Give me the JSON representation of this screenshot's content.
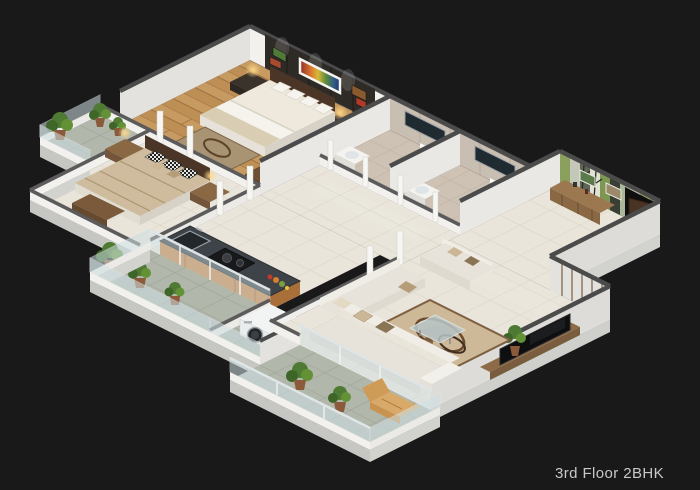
{
  "caption": "3rd Floor 2BHK",
  "colors": {
    "background": "#191919",
    "caption_text": "#c9c9c9",
    "wall_lit": "#f2f1ee",
    "wall_shade": "#dddcd8",
    "wall_cap": "#4b4b4b",
    "wood_floor": "#bd8f55",
    "cream_tile": "#e9e5da",
    "balcony_tile": "#b2b7ac",
    "bath_tile": "#cdc2b4",
    "accent_wall": "#2e2a26",
    "green_feature_wall": "#8ca05e",
    "kitchen_cabinet": "#c98546",
    "counter_top": "#3d4348",
    "sofa_cream": "#e7e3da",
    "glass": "#cfe0e4",
    "plant_green": "#4e7a33",
    "door_wood": "#4a3322",
    "lamp_glow": "#ffd98a"
  },
  "scene": {
    "type": "3d-isometric-floor-plan",
    "unit": "2BHK apartment",
    "rooms": [
      {
        "name": "master bedroom",
        "floor": "wood",
        "furniture": [
          "double bed",
          "pillows",
          "headboard",
          "nightstands with lamps",
          "dark accent wall",
          "colorful wall art",
          "rug",
          "dresser"
        ]
      },
      {
        "name": "second bedroom",
        "floor": "cream tile",
        "furniture": [
          "double bed",
          "checkered pillows",
          "nightstands with lamps",
          "foot bench"
        ]
      },
      {
        "name": "master bathroom",
        "floor": "beige tile",
        "furniture": [
          "toilet",
          "mirror",
          "basin",
          "shower"
        ]
      },
      {
        "name": "common bathroom",
        "floor": "beige tile",
        "furniture": [
          "toilet",
          "mirror",
          "basin"
        ]
      },
      {
        "name": "entrance foyer",
        "floor": "cream tile",
        "furniture": [
          "green striped feature wall",
          "wall frames",
          "wooden console",
          "open entry door"
        ]
      },
      {
        "name": "hallway",
        "floor": "cream tile",
        "furniture": []
      },
      {
        "name": "kitchen",
        "floor": "cream tile",
        "furniture": [
          "granite counter",
          "gas stove",
          "sink",
          "vegetables",
          "orange cabinets"
        ]
      },
      {
        "name": "utility",
        "floor": "gray tile",
        "furniture": [
          "washing machine"
        ]
      },
      {
        "name": "living room",
        "floor": "cream tile",
        "furniture": [
          "L-shaped sofa",
          "loveseat",
          "patterned rug",
          "glass coffee table",
          "TV on wooden unit",
          "plant"
        ]
      },
      {
        "name": "bedroom balcony",
        "floor": "gray tile",
        "furniture": [
          "potted plants",
          "glass railing"
        ]
      },
      {
        "name": "kitchen balcony",
        "floor": "gray tile",
        "furniture": [
          "potted plants",
          "glass railing"
        ]
      },
      {
        "name": "living balcony",
        "floor": "gray tile",
        "furniture": [
          "lounge chair",
          "potted plants",
          "glass railing"
        ]
      }
    ]
  }
}
